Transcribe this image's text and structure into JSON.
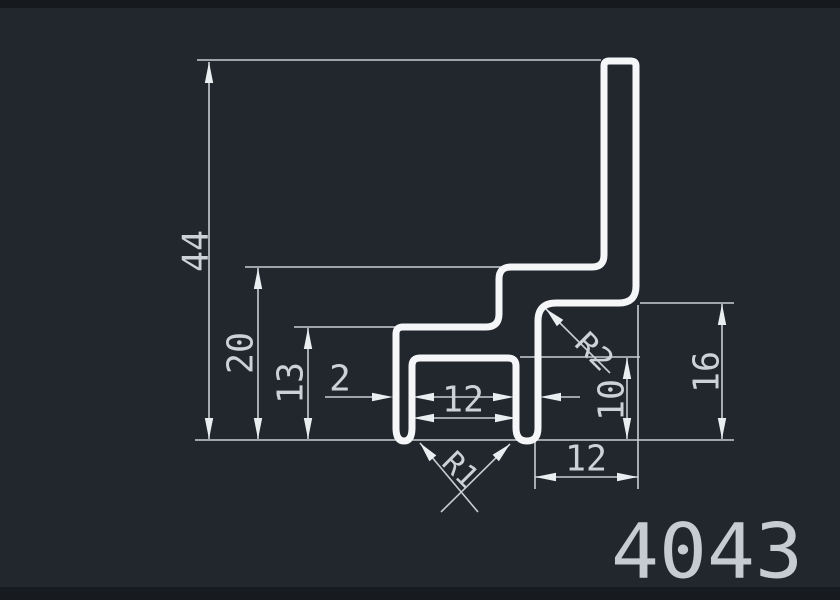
{
  "drawing": {
    "part_number": "4043",
    "dimensions": {
      "overall_height": "44",
      "upper_step_height": "20",
      "lower_step_height": "13",
      "wall_thickness": "2",
      "channel_inner_width": "12",
      "channel_depth": "10",
      "right_flange_height": "16",
      "right_flange_width": "12",
      "step_corner_radius": "R2",
      "leg_corner_radius": "R1"
    },
    "colors": {
      "background": "#22262d",
      "profile_line": "#f4f6f7",
      "dimension_line": "#c7cdd3",
      "text": "#ccd2d7"
    }
  }
}
